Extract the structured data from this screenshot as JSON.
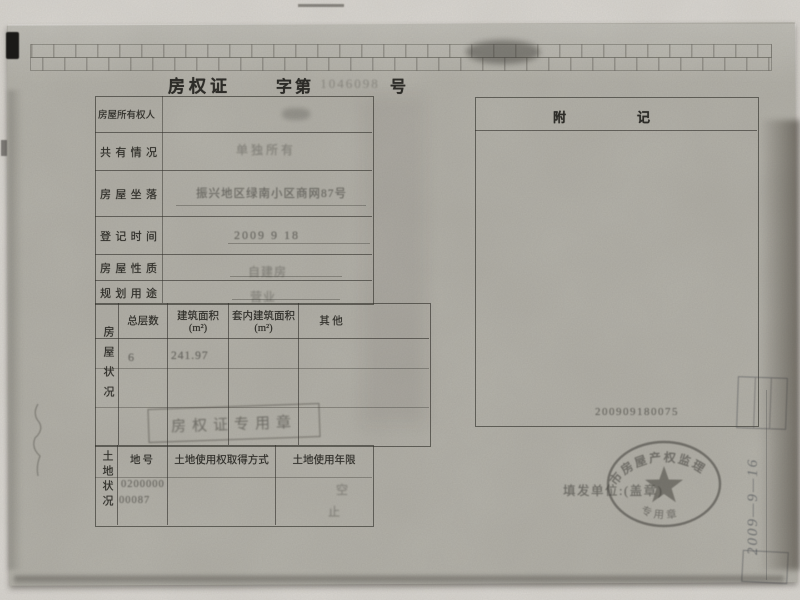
{
  "certificate": {
    "title": {
      "name": "房权证",
      "zi_di": "字第",
      "serial": "1046098",
      "hao": "号"
    },
    "fields": [
      {
        "label": "房屋所有权人",
        "value": ""
      },
      {
        "label": "共有情况",
        "value": "单独所有"
      },
      {
        "label": "房屋坐落",
        "value": "振兴地区绿南小区商网87号"
      },
      {
        "label": "登记时间",
        "value": "2009 9 18"
      },
      {
        "label": "房屋性质",
        "value": "自建房"
      },
      {
        "label": "规划用途",
        "value": "营业"
      }
    ],
    "building": {
      "side_label": "房屋状况",
      "headers": [
        {
          "l1": "总层数",
          "l2": ""
        },
        {
          "l1": "建筑面积",
          "l2": "(m²)"
        },
        {
          "l1": "套内建筑面积",
          "l2": "(m²)"
        },
        {
          "l1": "其  他",
          "l2": ""
        }
      ],
      "values": {
        "floors": "6",
        "area": "241.97",
        "inner_area": "",
        "other": ""
      }
    },
    "land": {
      "side_label": "土地状况",
      "headers": [
        "地号",
        "土地使用权取得方式",
        "土地使用年限"
      ],
      "parcel_no_line1": "0200000",
      "parcel_no_line2": "00087",
      "note_top": "空",
      "note_bottom": "止"
    },
    "annex": {
      "header_left": "附",
      "header_right": "记",
      "number": "200909180075"
    },
    "issue": {
      "label": "填发单位:(盖章)"
    },
    "seal": {
      "arc_top": "市房屋产权监理",
      "arc_bottom": "专用章"
    },
    "stamps": {
      "rect_stamp": "房权证专用章",
      "side_note": "2009—9—16"
    }
  }
}
